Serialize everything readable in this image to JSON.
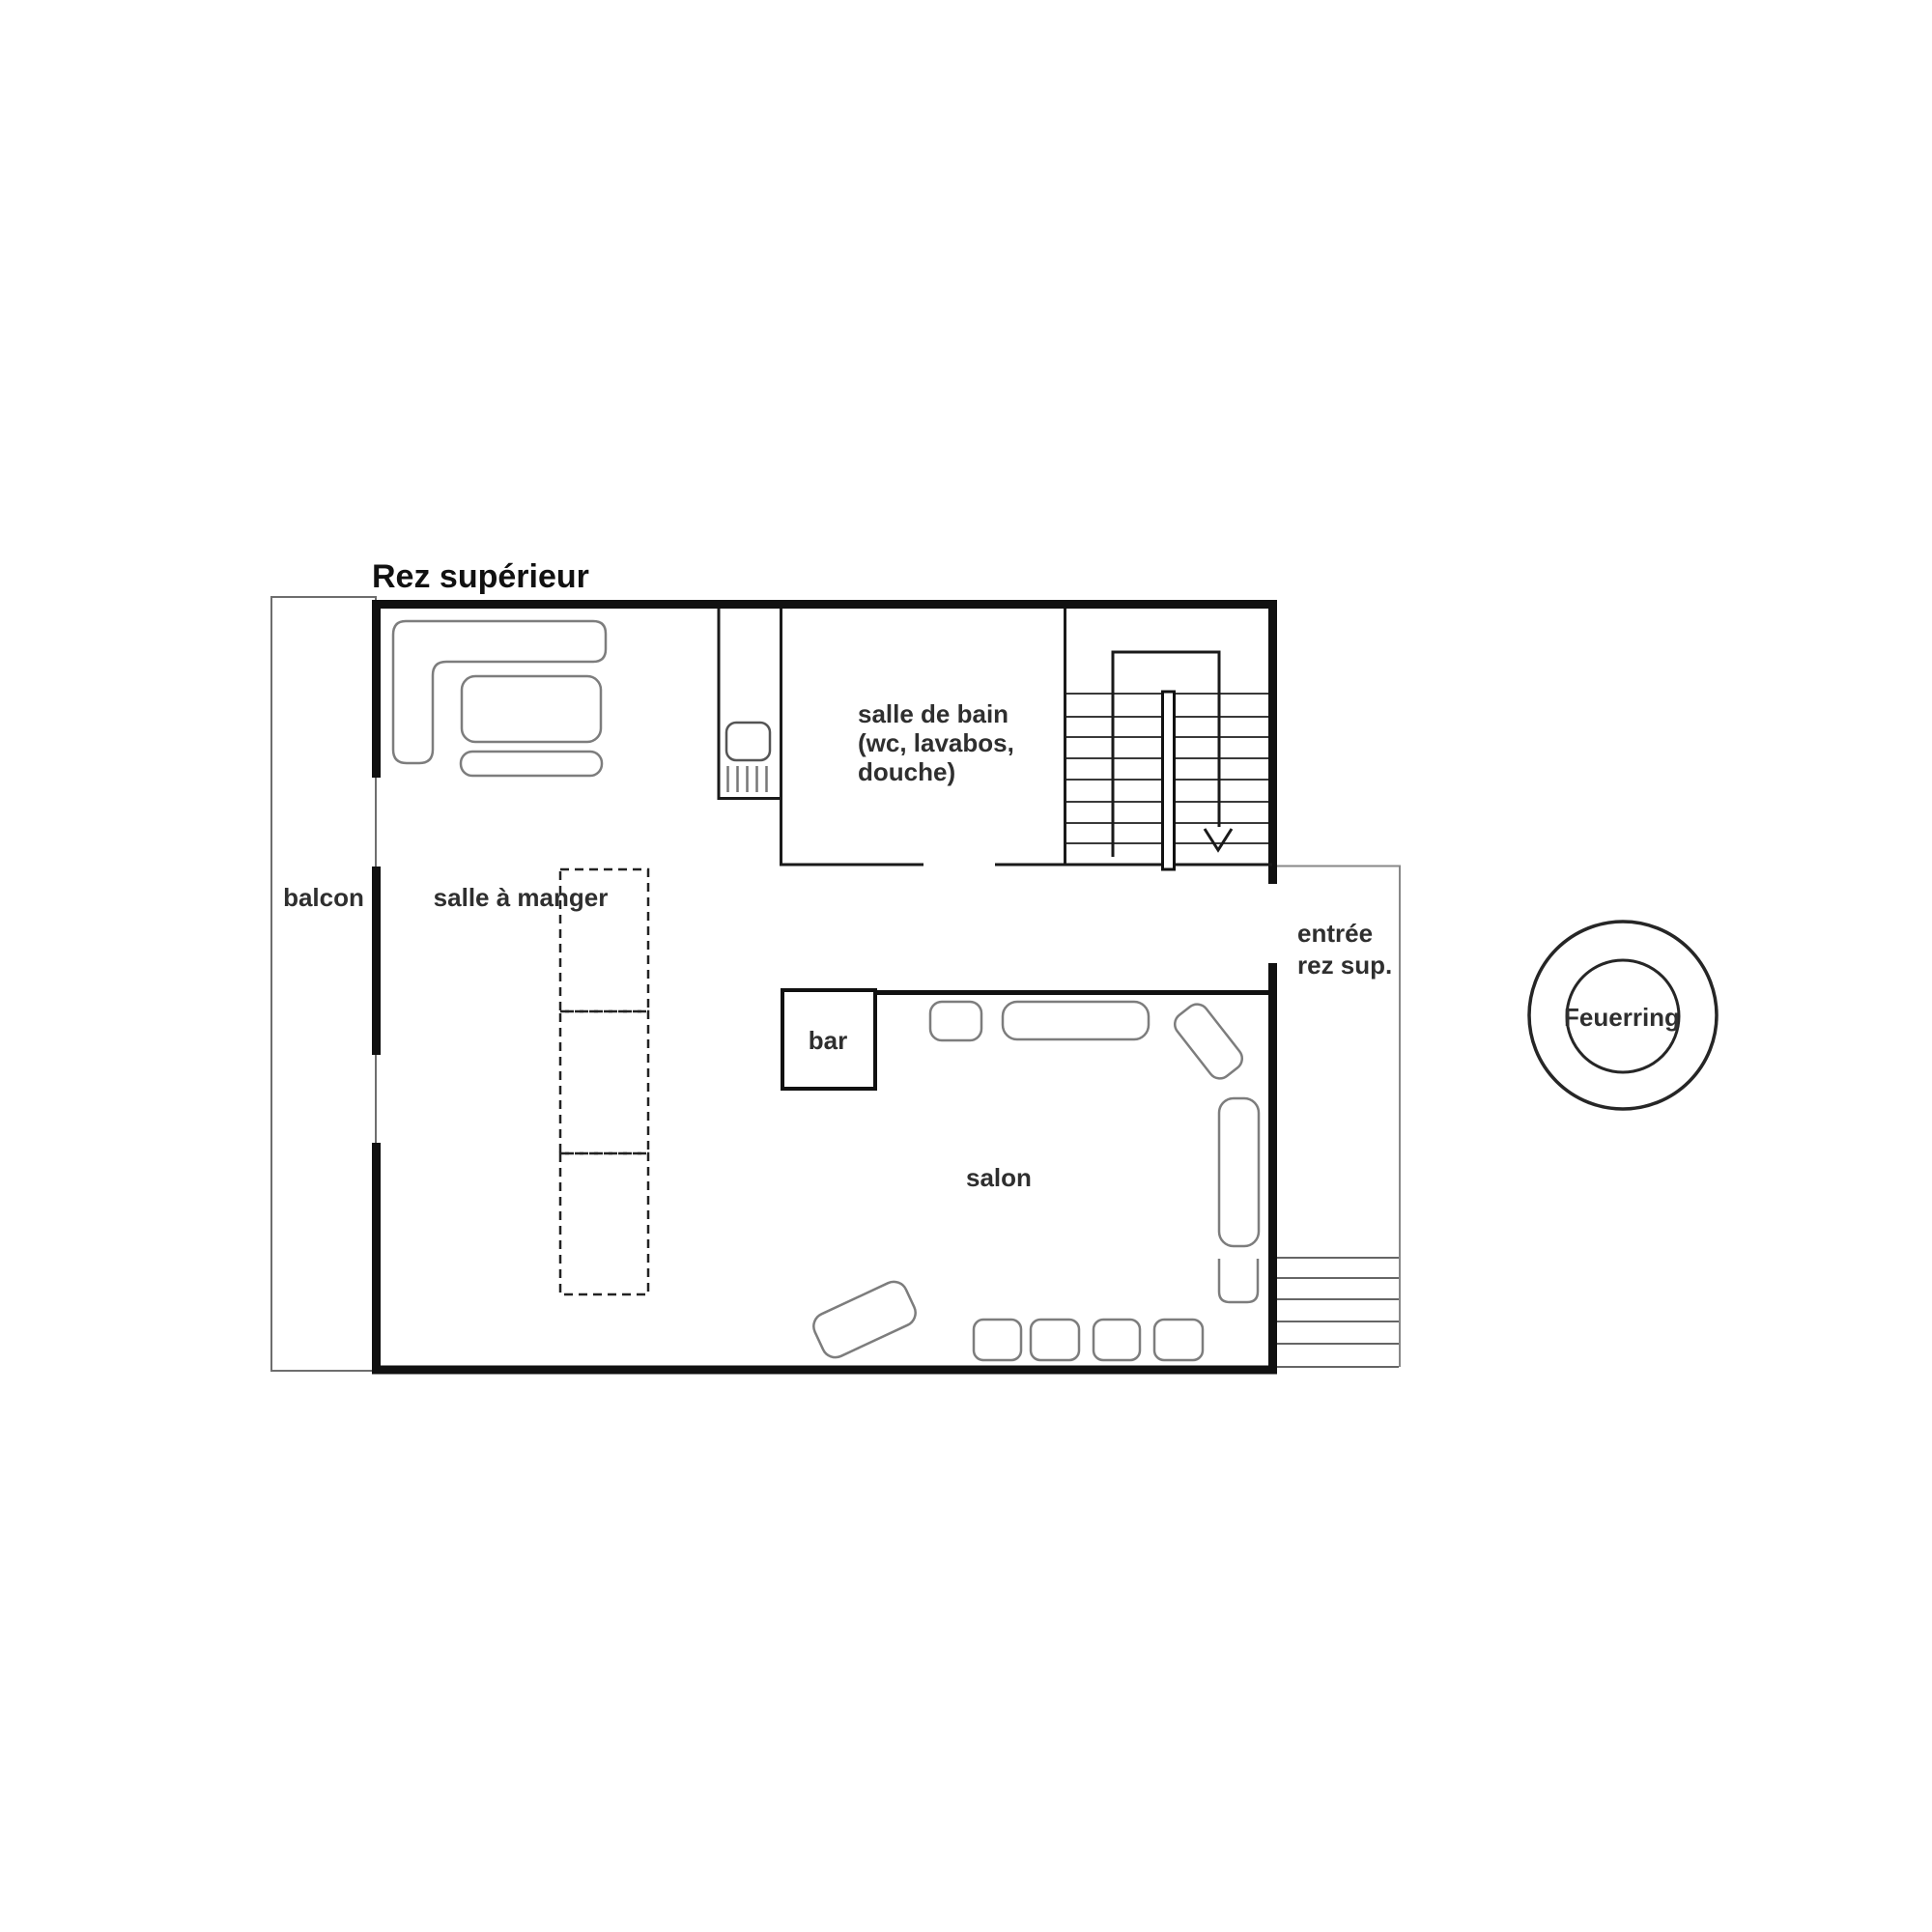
{
  "title": "Rez supérieur",
  "labels": {
    "balcony": "balcon",
    "dining": "salle à manger",
    "bathroom_line1": "salle de bain",
    "bathroom_line2": "(wc, lavabos,",
    "bathroom_line3": "douche)",
    "bar": "bar",
    "salon": "salon",
    "entrance_line1": "entrée",
    "entrance_line2": "rez sup.",
    "firering": "Feuerring"
  },
  "colors": {
    "wall": "#111111",
    "interior_wall": "#1a1a1a",
    "furniture_stroke": "#7d7d7d",
    "thin_outline": "#888888",
    "stair_line": "#666666",
    "text": "#2f2f2f",
    "background": "#ffffff"
  }
}
